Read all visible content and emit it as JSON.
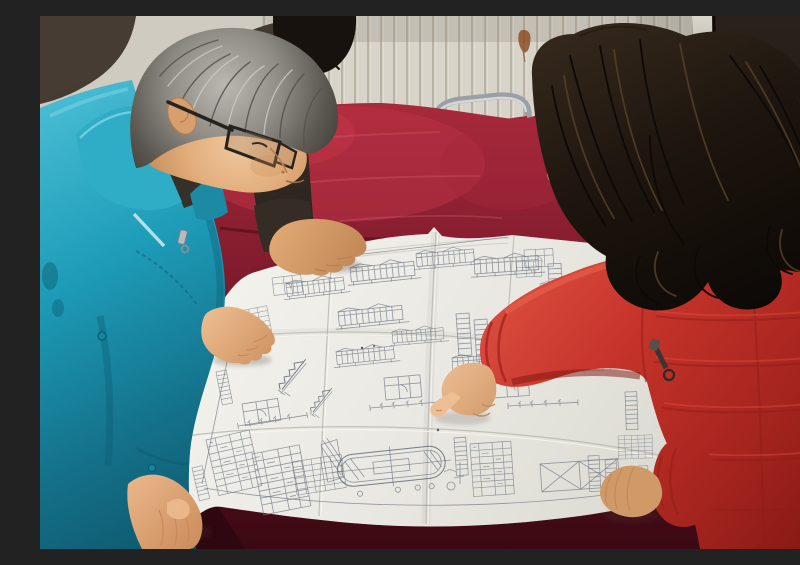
{
  "scene": {
    "description": "Photograph of three people leaning over a large folded engineering blueprint spread on a red velvet covered table in a plain room",
    "setting": "indoor room with white vertical-fin radiator wall, dark door at right, metal chair behind the table",
    "people": {
      "engineer": {
        "position": "left",
        "hair": "short gray hair",
        "eyewear": "dark rectangular glasses",
        "clothing": "bright teal work jacket over dark inner shirt with reflective stripe and zipper pull",
        "pose": "bent over the table studying the drawing, right hand on the sheet edge, left hand on the near corner"
      },
      "bystander": {
        "position": "behind engineer, top center",
        "hair": "short black hair",
        "clothing": "dark charcoal-brown jacket",
        "pose": "standing behind, one hand resting on the top edge of the drawing"
      },
      "visitor": {
        "position": "right",
        "hair": "long dark wavy hair",
        "clothing": "red quilted winter coat with orange fur-trimmed hood and dangling zipper pull",
        "pose": "pointing at a detail on the blueprint with right index finger, left hand resting on the sheet"
      }
    },
    "objects": {
      "blueprint": {
        "description": "large multi-fold white engineering drawing covered with elevations, sections, stair details, schedules, dimension strings and an oval tank plan",
        "paper_color": "#e9e8e2",
        "ink_color": "#6d7480"
      },
      "table": {
        "description": "table draped in worn dark red velvet cloth",
        "color": "#8c1f2e"
      },
      "chair": {
        "description": "metal tube framed chair with red back visible behind the table"
      },
      "wall": {
        "description": "cream radiator wall with vertical fins",
        "color": "#d8d4c9"
      },
      "door": {
        "description": "very dark door filling the right edge with pale frame strip",
        "color": "#1d1814"
      },
      "stain": {
        "description": "small rust stain on the wall left of the door"
      }
    },
    "palette": {
      "teal_jacket": "#1e9db9",
      "red_coat": "#c5332a",
      "fur_trim": "#cf7517",
      "velvet": "#8c1f2e",
      "wall": "#d8d4c9",
      "door": "#1d1814",
      "paper": "#e9e8e2",
      "gray_hair": "#8e8c85",
      "dark_hair": "#1d150e",
      "skin": "#dfa878"
    }
  }
}
